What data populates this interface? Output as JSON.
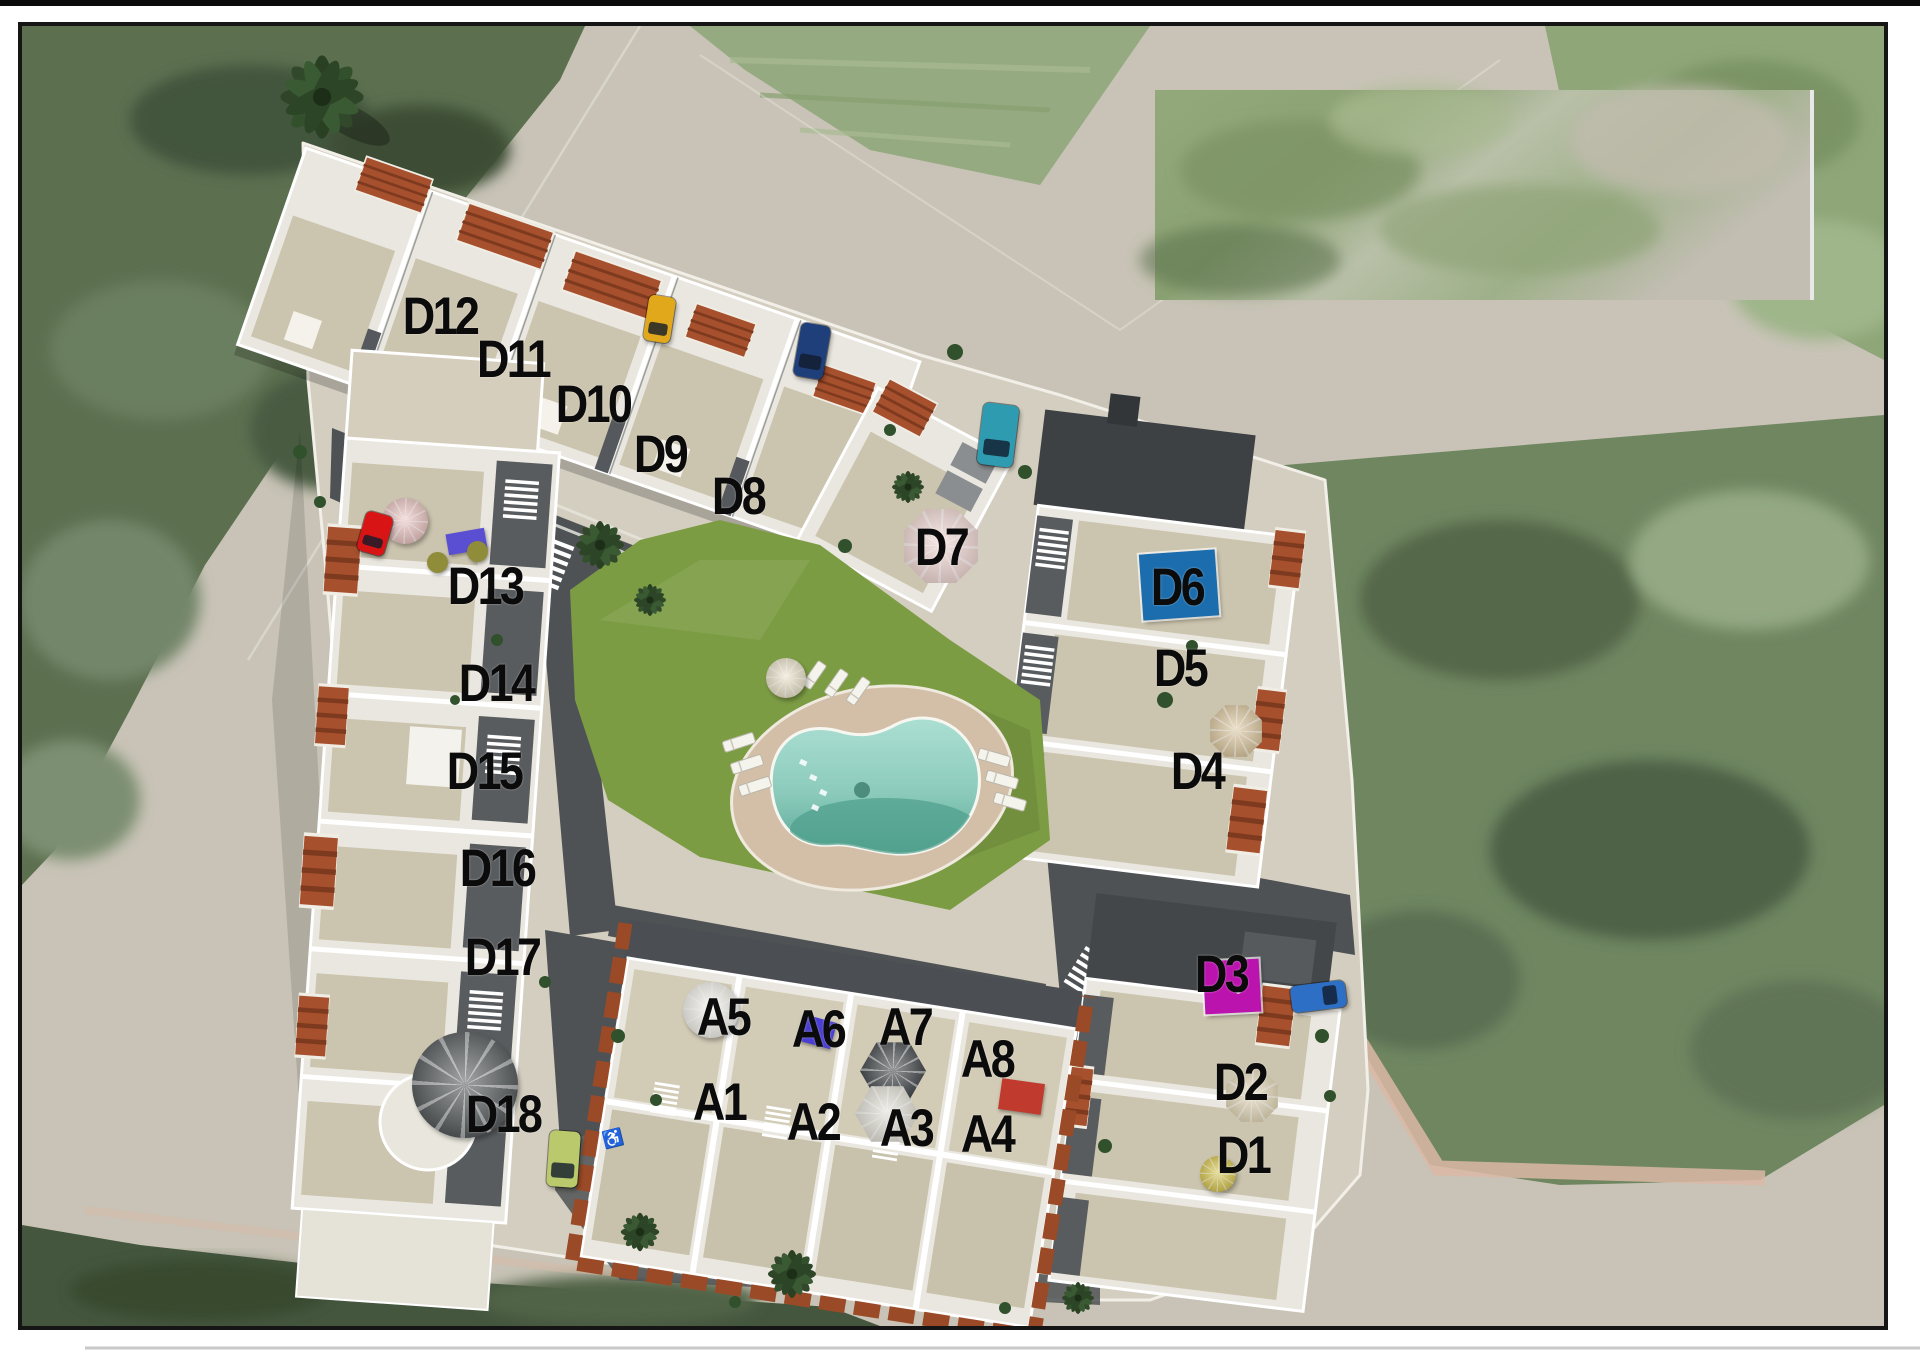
{
  "map": {
    "description_tag": "residential-development-site-plan-aerial",
    "unit_label_color": "#0b0b0b",
    "units": [
      {
        "id": "D12",
        "x": 440,
        "y": 316
      },
      {
        "id": "D11",
        "x": 513,
        "y": 359
      },
      {
        "id": "D10",
        "x": 593,
        "y": 404
      },
      {
        "id": "D9",
        "x": 660,
        "y": 454
      },
      {
        "id": "D8",
        "x": 738,
        "y": 496
      },
      {
        "id": "D7",
        "x": 941,
        "y": 547
      },
      {
        "id": "D13",
        "x": 485,
        "y": 586
      },
      {
        "id": "D14",
        "x": 496,
        "y": 683
      },
      {
        "id": "D15",
        "x": 484,
        "y": 771
      },
      {
        "id": "D16",
        "x": 497,
        "y": 868
      },
      {
        "id": "D17",
        "x": 502,
        "y": 957
      },
      {
        "id": "D18",
        "x": 503,
        "y": 1114
      },
      {
        "id": "D6",
        "x": 1177,
        "y": 587
      },
      {
        "id": "D5",
        "x": 1180,
        "y": 668
      },
      {
        "id": "D4",
        "x": 1197,
        "y": 771
      },
      {
        "id": "D3",
        "x": 1221,
        "y": 974
      },
      {
        "id": "D2",
        "x": 1240,
        "y": 1082
      },
      {
        "id": "D1",
        "x": 1243,
        "y": 1155
      },
      {
        "id": "A5",
        "x": 723,
        "y": 1017
      },
      {
        "id": "A6",
        "x": 818,
        "y": 1029
      },
      {
        "id": "A7",
        "x": 905,
        "y": 1027
      },
      {
        "id": "A8",
        "x": 987,
        "y": 1059
      },
      {
        "id": "A1",
        "x": 719,
        "y": 1102
      },
      {
        "id": "A2",
        "x": 813,
        "y": 1122
      },
      {
        "id": "A3",
        "x": 906,
        "y": 1128
      },
      {
        "id": "A4",
        "x": 987,
        "y": 1134
      }
    ],
    "features": {
      "pools": [
        {
          "name": "rooftop-pool-d6",
          "color": "#1c6dad",
          "x": 1141,
          "y": 552,
          "w": 76,
          "h": 66,
          "angle": -4,
          "dot": false
        },
        {
          "name": "rooftop-pool-d3",
          "color": "#bb14ae",
          "x": 1204,
          "y": 960,
          "w": 56,
          "h": 53,
          "angle": -3,
          "dot": true
        }
      ],
      "cars": [
        {
          "name": "car-yellow",
          "color": "#e2a81c",
          "x": 646,
          "y": 296,
          "w": 27,
          "h": 46,
          "angle": 9,
          "wide": false
        },
        {
          "name": "car-darkblue",
          "color": "#1f3f7a",
          "x": 797,
          "y": 324,
          "w": 30,
          "h": 54,
          "angle": 10,
          "wide": false
        },
        {
          "name": "car-teal",
          "color": "#2f9bb0",
          "x": 980,
          "y": 404,
          "w": 36,
          "h": 62,
          "angle": 7,
          "wide": false
        },
        {
          "name": "car-blue",
          "color": "#2d6fc4",
          "x": 1291,
          "y": 983,
          "w": 55,
          "h": 27,
          "angle": -7,
          "wide": true
        },
        {
          "name": "car-lime",
          "color": "#b9c96b",
          "x": 548,
          "y": 1131,
          "w": 31,
          "h": 56,
          "angle": 4,
          "wide": false
        },
        {
          "name": "car-red",
          "color": "#d81414",
          "x": 361,
          "y": 513,
          "w": 28,
          "h": 41,
          "angle": 16,
          "wide": false
        }
      ],
      "umbrellas": [
        {
          "name": "umbrella-pink-d7",
          "color": "#efd6d2",
          "x": 941,
          "y": 546,
          "r": 40,
          "sides": 8
        },
        {
          "name": "parasol-pink-d13",
          "color": "#e9c4c1",
          "x": 405,
          "y": 521,
          "r": 23,
          "sides": 16
        },
        {
          "name": "umbrella-beige-d4",
          "color": "#d9c49c",
          "x": 1236,
          "y": 731,
          "r": 28,
          "sides": 8
        },
        {
          "name": "umbrella-beige-d2",
          "color": "#e2d6b6",
          "x": 1252,
          "y": 1096,
          "r": 28,
          "sides": 8
        },
        {
          "name": "umbrella-dark-a3",
          "color": "#3e4245",
          "x": 893,
          "y": 1071,
          "r": 33,
          "sides": 6
        },
        {
          "name": "umbrella-white-a3",
          "color": "#dfddd3",
          "x": 887,
          "y": 1114,
          "r": 32,
          "sides": 6
        },
        {
          "name": "umbrella-cream-lawn",
          "color": "#e9e1c9",
          "x": 786,
          "y": 678,
          "r": 20,
          "sides": 12
        },
        {
          "name": "parasol-white-a5",
          "color": "#f2f1ea",
          "x": 711,
          "y": 1010,
          "r": 28,
          "sides": 16
        },
        {
          "name": "umbrella-round-d18",
          "color": "#55595b",
          "x": 465,
          "y": 1085,
          "r": 53,
          "sides": 24
        },
        {
          "name": "palm-starburst-d1",
          "color": "#d6c44e",
          "x": 1218,
          "y": 1174,
          "r": 18,
          "sides": 12
        }
      ],
      "furniture": [
        {
          "name": "sofa-purple-d13",
          "color": "#5a4fd2",
          "x": 447,
          "y": 531,
          "w": 39,
          "h": 21,
          "angle": -10,
          "round": false
        },
        {
          "name": "loungers-purple-a6",
          "color": "#4a3fd0",
          "x": 799,
          "y": 1018,
          "w": 35,
          "h": 27,
          "angle": 15,
          "round": false
        },
        {
          "name": "bbq-red-a4",
          "color": "#c03a2e",
          "x": 1000,
          "y": 1081,
          "w": 43,
          "h": 31,
          "angle": 8,
          "round": false
        },
        {
          "name": "table-olive-1",
          "color": "#8f8d3a",
          "x": 427,
          "y": 552,
          "w": 21,
          "h": 21,
          "angle": 0,
          "round": true
        },
        {
          "name": "table-olive-2",
          "color": "#8f8d3a",
          "x": 467,
          "y": 541,
          "w": 21,
          "h": 21,
          "angle": 0,
          "round": true
        }
      ],
      "icons": [
        {
          "name": "accessible-parking-icon",
          "glyph": "♿",
          "x": 613,
          "y": 1139,
          "size": 17,
          "color": "#e8e8e8",
          "angle": -14
        }
      ]
    },
    "palette": {
      "road": "#c8c3b6",
      "plot_concrete": "#d4cec0",
      "building_white": "#e9e7df",
      "terrace_beige": "#cbc4ae",
      "inner_street": "#4f5255",
      "terracotta_roof": "#a6502d",
      "dark_roof": "#3e4144",
      "lawn": "#7c9c44",
      "pool_water": "#9ed6c8",
      "pool_deck": "#d3bfa7",
      "scrub_green": "#566b4e",
      "field_green": "#6e8660",
      "sidewalk_pink": "#dcb9a6",
      "border_black": "#151515"
    }
  }
}
